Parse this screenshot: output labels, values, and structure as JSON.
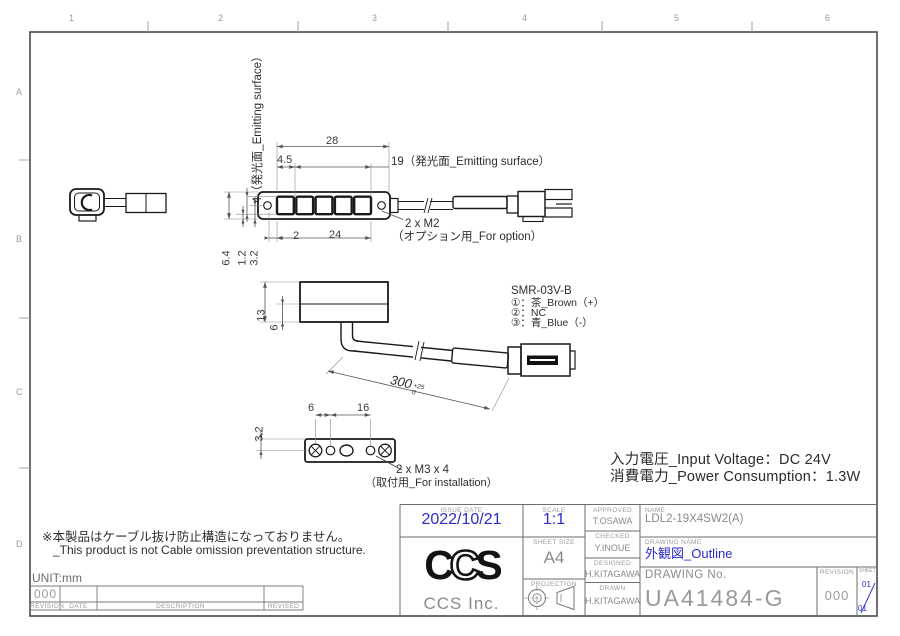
{
  "drawing": {
    "border": {
      "cols": [
        "1",
        "2",
        "3",
        "4",
        "5",
        "6"
      ],
      "rows": [
        "A",
        "B",
        "C",
        "D"
      ]
    },
    "top_view": {
      "dim_length": "28",
      "dim_offset": "4.5",
      "dim_emitting": "19（発光面_Emitting surface）",
      "dim_hole_offset": "2",
      "dim_pitch": "24",
      "dim_height": "6.4",
      "dim_gap": "1.2",
      "dim_center": "3.2",
      "dim_emitting_height": "4（発光面_Emitting surface）",
      "m2_note": "2 x M2",
      "m2_note_sub": "（オプション用_For option）"
    },
    "side_view": {
      "dim_height": "13",
      "dim_lower": "6",
      "dim_cable": "300",
      "cable_tol_upper": "+25",
      "cable_tol_lower": "0",
      "connector_model": "SMR-03V-B",
      "pin1": "①：茶_Brown（+）",
      "pin2": "②：NC",
      "pin3": "③：青_Blue（-）"
    },
    "bottom_view": {
      "dim_edge": "3.2",
      "dim_hole1": "6",
      "dim_hole2": "16",
      "m3_note": "2 x M3 x 4",
      "m3_note_sub": "（取付用_For installation）"
    },
    "specs": {
      "input_voltage": "入力電圧_Input Voltage：DC 24V",
      "power_consumption": "消費電力_Power Consumption：1.3W"
    },
    "note": {
      "jp": "※本製品はケーブル抜け防止構造になっておりません。",
      "en": "_This product is not Cable omission preventation structure."
    },
    "unit_label": "UNIT:mm"
  },
  "revision_table": {
    "current_revision": "000",
    "headers": {
      "revision": "REVISION",
      "date": "DATE",
      "description": "DESCRIPTION",
      "revised": "REVISED"
    }
  },
  "title_block": {
    "issue_date_label": "ISSUE DATE",
    "issue_date": "2022/10/21",
    "scale_label": "SCALE",
    "scale": "1:1",
    "sheet_size_label": "SHEET  SIZE",
    "sheet_size": "A4",
    "projection_label": "PROJECTION",
    "approved_label": "APPROVED",
    "approved": "T.OSAWA",
    "checked_label": "CHECKED",
    "checked": "Y.INOUE",
    "designed_label": "DESIGNED",
    "designed": "H.KITAGAWA",
    "drawn_label": "DRAWN",
    "drawn": "H.KITAGAWA",
    "name_label": "NAME",
    "name": "LDL2-19X4SW2(A)",
    "drawing_name_label": "DRAWING NAME",
    "drawing_name": "外観図_Outline",
    "drawing_no_label": "DRAWING No.",
    "drawing_no": "UA41484-G",
    "revision_label": "REVISION",
    "revision": "000",
    "sheet_label": "SHEET",
    "sheet_current": "01",
    "sheet_total": "01",
    "logo_letters": [
      "C",
      "C",
      "S"
    ],
    "company_name": "CCS Inc."
  },
  "colors": {
    "accent_blue": "#2b2bd0",
    "line_dark": "#1c1c1c",
    "dim_line": "#555555",
    "muted_gray": "#8a8a8a"
  }
}
